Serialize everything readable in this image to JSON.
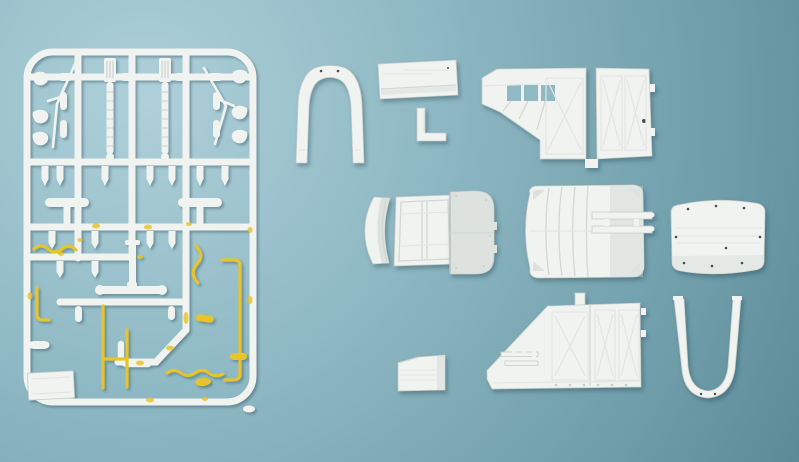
{
  "scene": {
    "description": "Overhead photograph of a white injection-moulded model kit: a rectangular parts sprue with small suspension and tubing parts (several hand-painted yellow) on the left, and twelve loose white body, roof and chassis panels laid out in three rows on a blue-grey surface",
    "colors": {
      "bg-light": "#aed0da",
      "bg-mid": "#8fb9c4",
      "bg-dark2": "#6f9daa",
      "bg-dark": "#5d8a97",
      "plastic": "#f1f3f0",
      "plastic-shade": "#dde2df",
      "plastic-edge": "#c7cdc9",
      "detail-line": "#d2d8d4",
      "detail-faint": "#e2e6e3",
      "paint-yellow": "#e8c42c",
      "shadow": "rgba(35,65,78,0.38)",
      "hole-dark": "#47504e"
    }
  },
  "sprue": {
    "id": "parts-sprue",
    "label": "runner frame with leaf springs, rods, hooks, bullets, T-levers and exhaust tubing; tubes painted yellow",
    "paint": "yellow"
  },
  "loose_parts": [
    {
      "id": "door-arch-frame",
      "label": "arched bulkhead / door frame"
    },
    {
      "id": "flat-floor-panel",
      "label": "flat rectangular floor panel"
    },
    {
      "id": "l-bracket",
      "label": "L-shaped bracket"
    },
    {
      "id": "body-side-panel-right",
      "label": "body side panel with window openings and braced double doors"
    },
    {
      "id": "curved-side-skirt",
      "label": "curved valance panel"
    },
    {
      "id": "rear-doors-panel",
      "label": "rear double-door panel"
    },
    {
      "id": "standing-roof-panel",
      "label": "curved end panel standing on edge"
    },
    {
      "id": "chassis-floor-pan",
      "label": "ribbed floor pan with twin chassis rails"
    },
    {
      "id": "flat-roof-panel",
      "label": "riveted roof panel"
    },
    {
      "id": "small-ribbed-panel",
      "label": "small louvred panel"
    },
    {
      "id": "body-side-panel-left",
      "label": "body side panel with steps and corner post"
    },
    {
      "id": "u-frame",
      "label": "U-shaped frame"
    },
    {
      "id": "loose-pellet",
      "label": "small loose plastic pellet"
    }
  ]
}
